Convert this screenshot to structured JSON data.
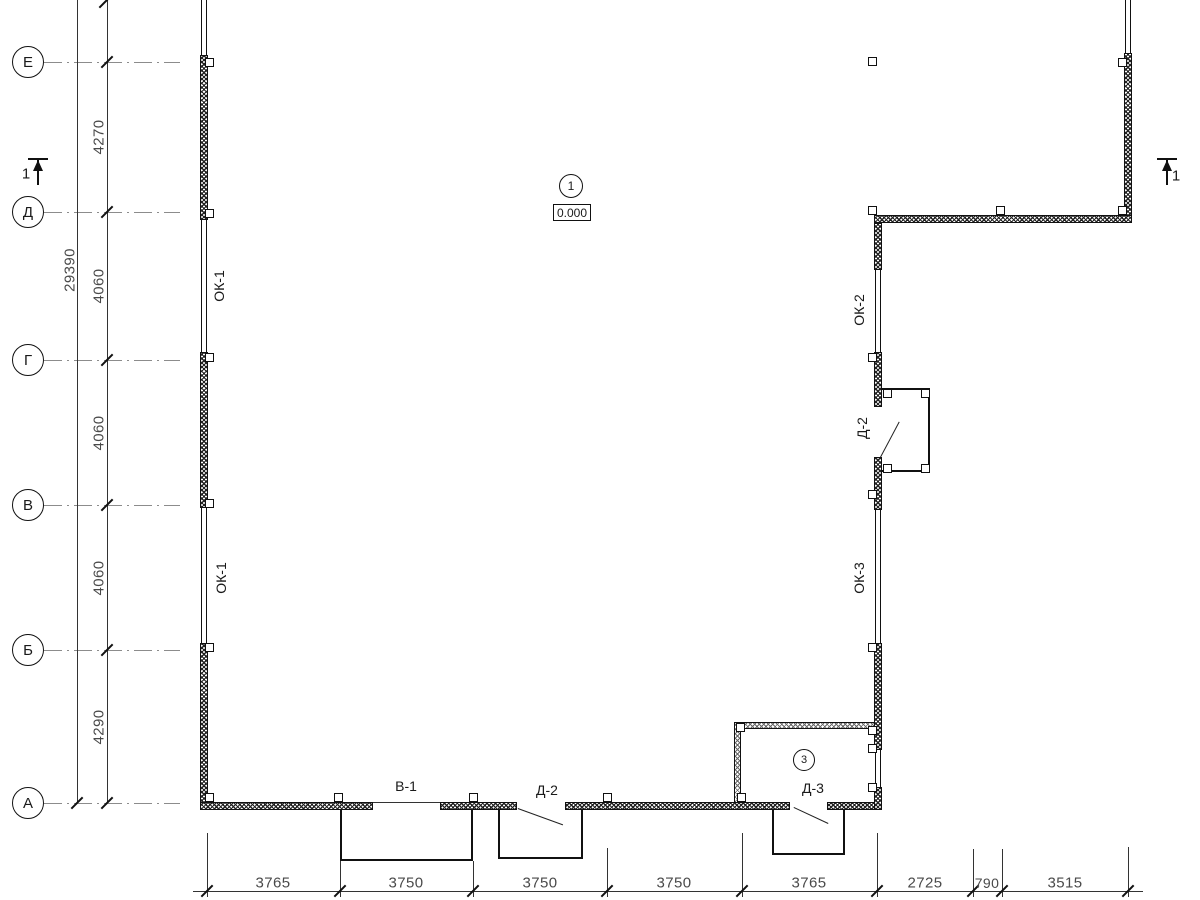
{
  "axes": {
    "rows": [
      {
        "label": "Е"
      },
      {
        "label": "Д"
      },
      {
        "label": "Г"
      },
      {
        "label": "В"
      },
      {
        "label": "Б"
      },
      {
        "label": "А"
      }
    ],
    "spacings": [
      "4270",
      "4060",
      "4060",
      "4060",
      "4290"
    ],
    "total": "29390"
  },
  "bottom_dims": [
    "3765",
    "3750",
    "3750",
    "3750",
    "3765",
    "2725",
    "790",
    "3515"
  ],
  "openings": {
    "ok1_upper": "ОК-1",
    "ok1_lower": "ОК-1",
    "ok2": "ОК-2",
    "ok3": "ОК-3",
    "d2_wall": "Д-2",
    "v1": "В-1",
    "d2_bottom": "Д-2",
    "d3": "Д-3"
  },
  "markers": {
    "room1": "1",
    "elevation": "0.000",
    "room3": "3",
    "section_left": "1",
    "section_right": "1"
  },
  "colors": {
    "line": "#1a1a1a",
    "dim_text": "#4a4a4a",
    "axis_line": "#8c8c8c"
  }
}
